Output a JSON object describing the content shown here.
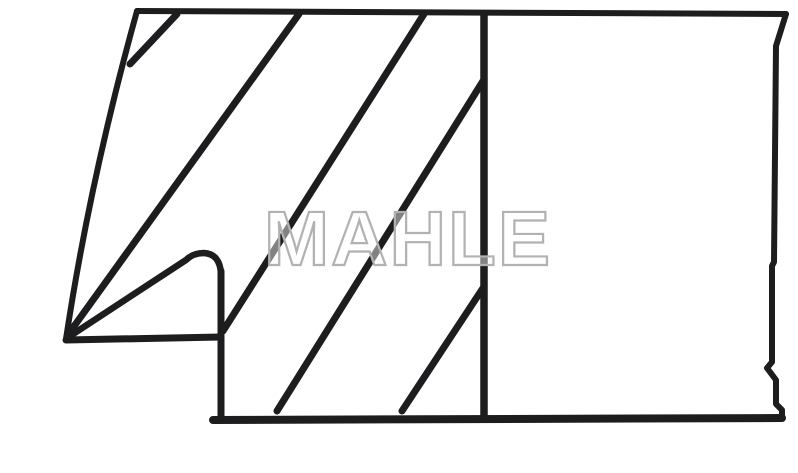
{
  "image": {
    "description": "Black-and-white technical line drawing: cross-section profile of a piston ring set with diagonal section hatching, a stepped scraper nose at lower left, and an un-hatched rectangular face at right",
    "canvas": {
      "width": 798,
      "height": 473
    },
    "colors": {
      "background": "#ffffff",
      "line": "#1d1d1f",
      "watermark_outline": "#b2b2b2",
      "watermark_fill": "rgba(255,255,255,0.45)"
    },
    "watermark": {
      "text": "MAHLE",
      "x": 264,
      "y": 265,
      "length": 288,
      "font_size": 77
    },
    "outline_paths": [
      {
        "name": "top-edge",
        "d": "M137,11 L786,14",
        "w": 6
      },
      {
        "name": "left-edge",
        "d": "M137,11 Q90,180 66,339",
        "w": 6
      },
      {
        "name": "right-edge",
        "d": "M786,14 L776,46 L774,262 L772,266 L772,362 L767,368 L776,380 L776,404 L782,410 L782,418",
        "w": 6
      },
      {
        "name": "bottom-edge",
        "d": "M213,420 L782,418",
        "w": 8
      },
      {
        "name": "step-vertical",
        "d": "M221,416 L221,271",
        "w": 7
      },
      {
        "name": "nose-hook",
        "d": "M221,274 Q220,254 204,253 Q193,253 186,260 L67,338",
        "w": 6.5
      },
      {
        "name": "step-horizontal",
        "d": "M66,340 L221,337",
        "w": 7
      },
      {
        "name": "divider-vertical",
        "d": "M484,14 L484,415",
        "w": 7.5
      }
    ],
    "hatch_lines": [
      {
        "x1": 177,
        "y1": 14,
        "x2": 130,
        "y2": 64
      },
      {
        "x1": 299,
        "y1": 14,
        "x2": 67,
        "y2": 336
      },
      {
        "x1": 424,
        "y1": 14,
        "x2": 223,
        "y2": 331
      },
      {
        "x1": 483,
        "y1": 81,
        "x2": 277,
        "y2": 411
      },
      {
        "x1": 483,
        "y1": 288,
        "x2": 402,
        "y2": 411
      }
    ],
    "hatch_width": 7
  }
}
